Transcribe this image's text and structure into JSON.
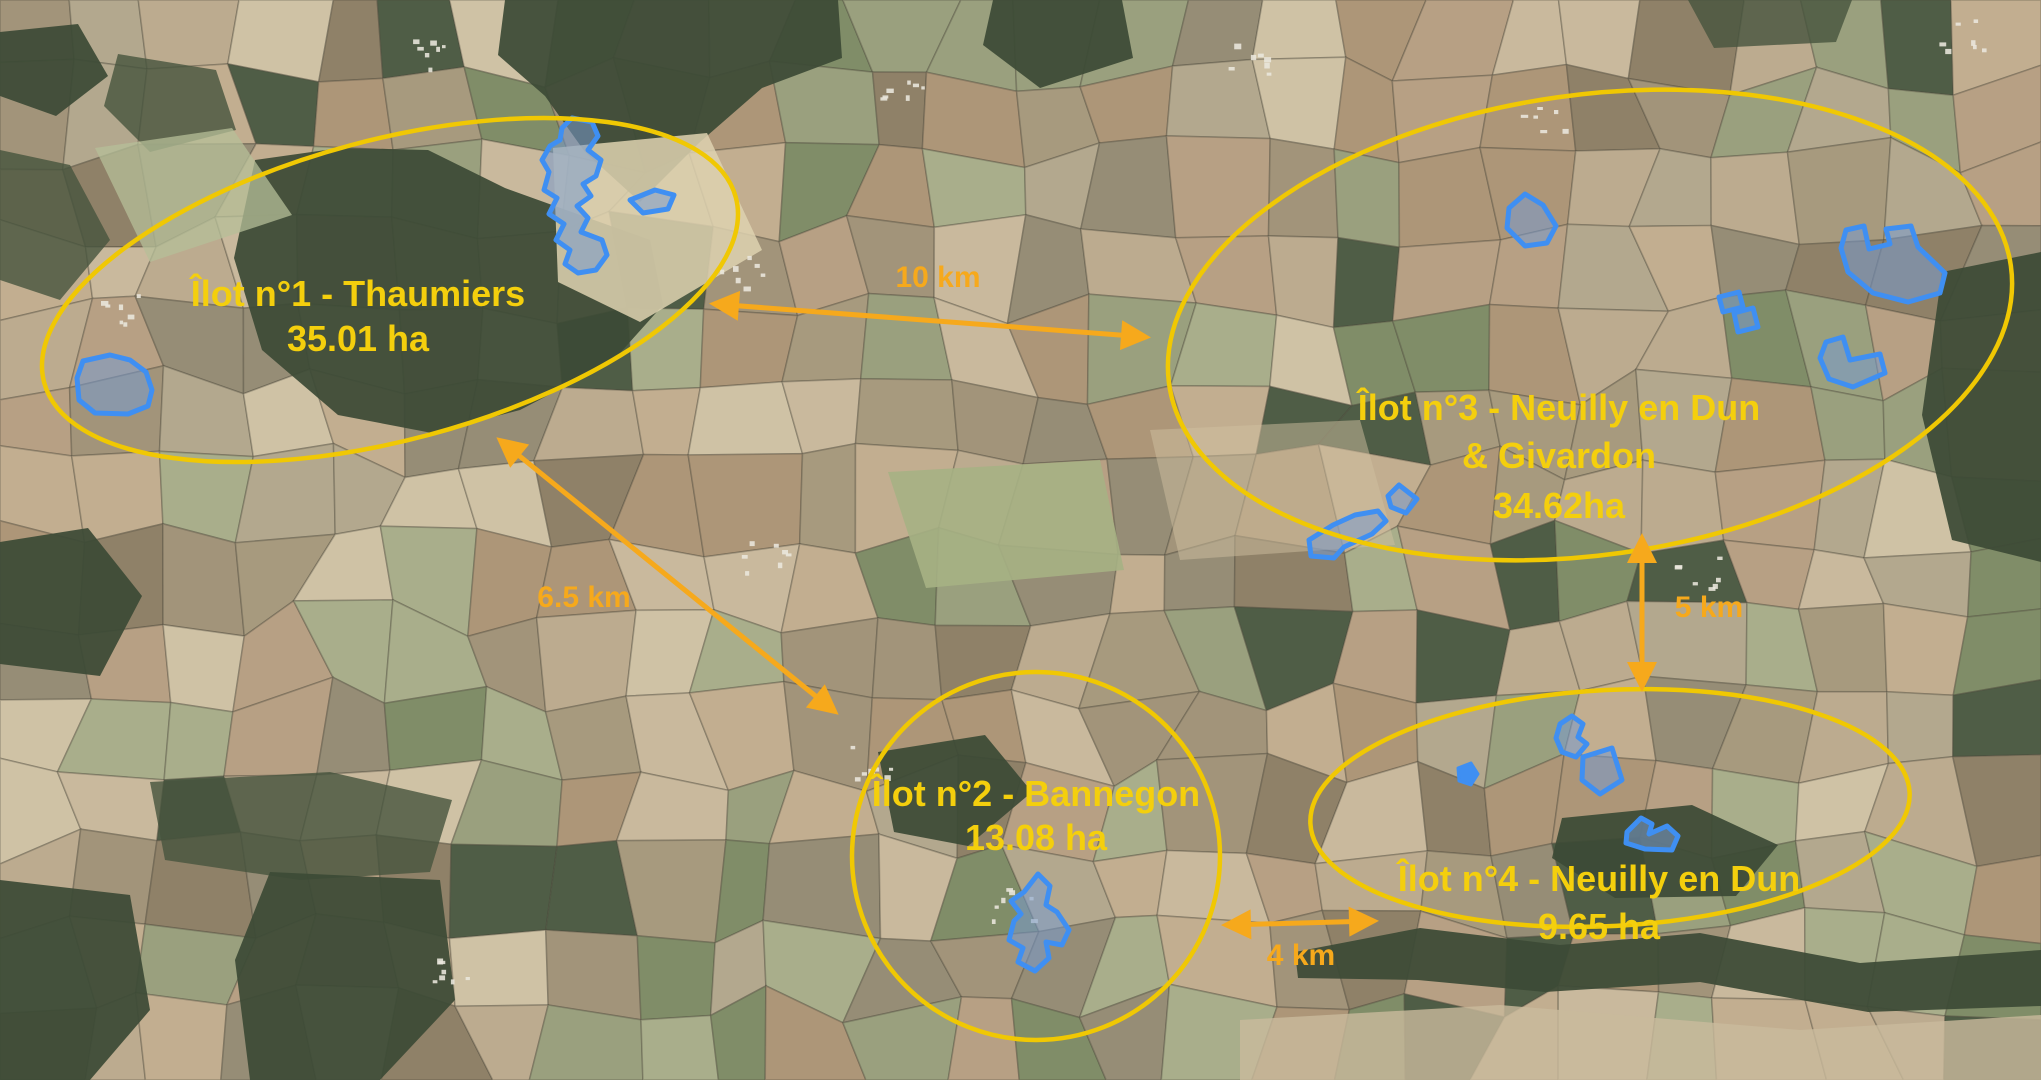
{
  "figure": {
    "type": "annotated-satellite-map",
    "zones": [
      {
        "id": "ilot-1",
        "lines": [
          "Îlot n°1 - Thaumiers",
          "35.01 ha"
        ]
      },
      {
        "id": "ilot-2",
        "lines": [
          "Îlot n°2 - Bannegon",
          "13.08 ha"
        ]
      },
      {
        "id": "ilot-3",
        "lines": [
          "Îlot n°3 - Neuilly en Dun",
          "& Givardon",
          "34.62ha"
        ]
      },
      {
        "id": "ilot-4",
        "lines": [
          "Îlot n°4 - Neuilly en Dun",
          "9.65 ha"
        ]
      }
    ],
    "distances": [
      {
        "id": "d-10km",
        "label": "10 km"
      },
      {
        "id": "d-6-5km",
        "label": "6.5 km"
      },
      {
        "id": "d-5km",
        "label": "5 km"
      },
      {
        "id": "d-4km",
        "label": "4 km"
      }
    ]
  },
  "colors": {
    "zone_yellow": "#f0c803",
    "label_yellow": "#f4cf0d",
    "distance_orange": "#f6a91c",
    "parcel_blue": "#3f8ff2",
    "parcel_fill": "rgba(120,155,205,0.55)"
  }
}
